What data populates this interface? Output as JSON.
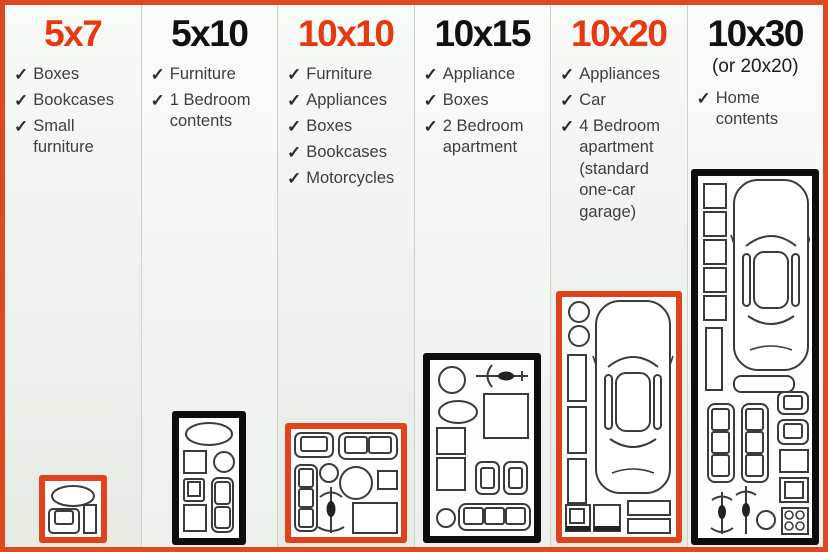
{
  "glyphs": {
    "check": "✓"
  },
  "colors": {
    "accent_red": "#e8380f",
    "title_black": "#111111",
    "frame_orange": "#dd4a1f",
    "diagram_black": "#0d0d0d",
    "text_gray": "#3e3e3e"
  },
  "units": [
    {
      "size": "5x7",
      "highlighted": true,
      "items": [
        "Boxes",
        "Bookcases",
        "Small furniture"
      ]
    },
    {
      "size": "5x10",
      "highlighted": false,
      "items": [
        "Furniture",
        "1 Bedroom contents"
      ]
    },
    {
      "size": "10x10",
      "highlighted": true,
      "items": [
        "Furniture",
        "Appliances",
        "Boxes",
        "Bookcases",
        "Motorcycles"
      ]
    },
    {
      "size": "10x15",
      "highlighted": false,
      "items": [
        "Appliance",
        "Boxes",
        "2 Bedroom apartment"
      ]
    },
    {
      "size": "10x20",
      "highlighted": true,
      "items": [
        "Appliances",
        "Car",
        "4 Bedroom apartment (standard one-car garage)"
      ]
    },
    {
      "size": "10x30",
      "subtitle": "(or 20x20)",
      "highlighted": false,
      "items": [
        "Home contents"
      ]
    }
  ]
}
